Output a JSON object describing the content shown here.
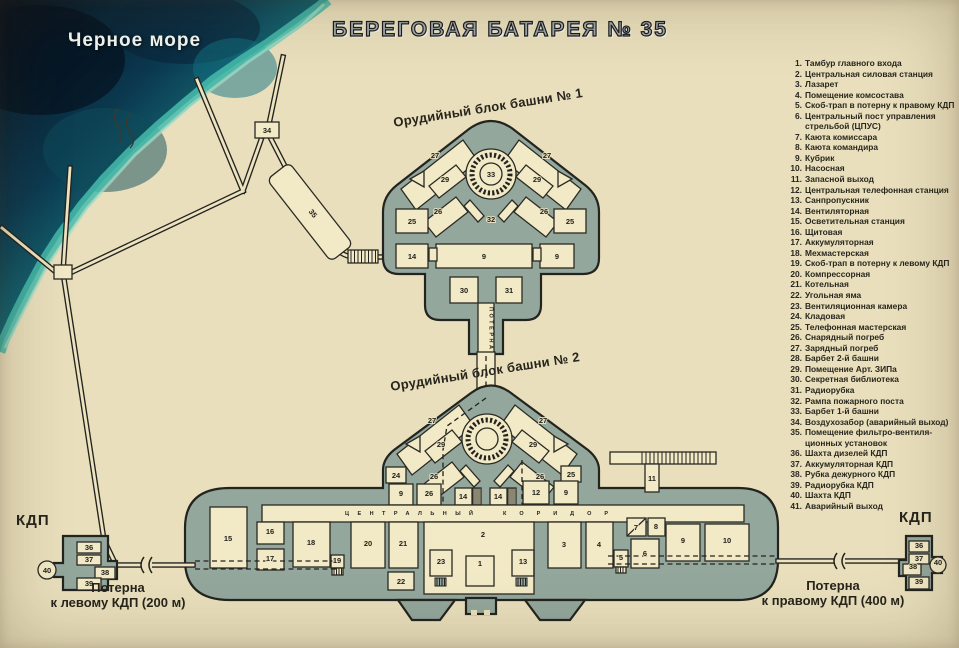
{
  "title": "БЕРЕГОВАЯ БАТАРЕЯ № 35",
  "sea": {
    "label": "Черное море"
  },
  "labels": {
    "turret1": "Орудийный блок башни № 1",
    "turret2": "Орудийный блок башни № 2",
    "kdp_left": "КДП",
    "kdp_right": "КДП",
    "potern_left_line1": "Потерна",
    "potern_left_line2": "к левому КДП (200 м)",
    "potern_right_line1": "Потерна",
    "potern_right_line2": "к правому КДП (400 м)",
    "corridor_word1": "ЦЕНТРАЛЬНЫЙ",
    "corridor_word2": "КОРИДОР",
    "potern_vertical": "ПОТЕРНА"
  },
  "colors": {
    "parchment": "#e9dfbc",
    "block_fill": "#93a79c",
    "room_fill": "#f2e9c6",
    "outline": "#24231e",
    "sea_deep": "#050f1c",
    "sea_shallow": "#35a99a"
  },
  "legend": {
    "items": [
      {
        "num": "1.",
        "text": "Тамбур главного входа"
      },
      {
        "num": "2.",
        "text": "Центральная силовая станция"
      },
      {
        "num": "3.",
        "text": "Лазарет"
      },
      {
        "num": "4.",
        "text": "Помещение комсостава"
      },
      {
        "num": "5.",
        "text": "Скоб-трап в потерну к правому КДП"
      },
      {
        "num": "6.",
        "text": "Центральный пост управления стрельбой (ЦПУС)"
      },
      {
        "num": "7.",
        "text": "Каюта комиссара"
      },
      {
        "num": "8.",
        "text": "Каюта командира"
      },
      {
        "num": "9.",
        "text": "Кубрик"
      },
      {
        "num": "10.",
        "text": "Насосная"
      },
      {
        "num": "11.",
        "text": "Запасной выход"
      },
      {
        "num": "12.",
        "text": "Центральная телефонная станция"
      },
      {
        "num": "13.",
        "text": "Санпропускник"
      },
      {
        "num": "14.",
        "text": "Вентиляторная"
      },
      {
        "num": "15.",
        "text": "Осветительная станция"
      },
      {
        "num": "16.",
        "text": "Щитовая"
      },
      {
        "num": "17.",
        "text": "Аккумуляторная"
      },
      {
        "num": "18.",
        "text": "Мехмастерская"
      },
      {
        "num": "19.",
        "text": "Скоб-трап в потерну к левому КДП"
      },
      {
        "num": "20.",
        "text": "Компрессорная"
      },
      {
        "num": "21.",
        "text": "Котельная"
      },
      {
        "num": "22.",
        "text": "Угольная яма"
      },
      {
        "num": "23.",
        "text": "Вентиляционная камера"
      },
      {
        "num": "24.",
        "text": "Кладовая"
      },
      {
        "num": "25.",
        "text": "Телефонная мастерская"
      },
      {
        "num": "26.",
        "text": "Снарядный погреб"
      },
      {
        "num": "27.",
        "text": "Зарядный погреб"
      },
      {
        "num": "28.",
        "text": "Барбет 2-й башни"
      },
      {
        "num": "29.",
        "text": "Помещение Арт. ЗИПа"
      },
      {
        "num": "30.",
        "text": "Секретная библиотека"
      },
      {
        "num": "31.",
        "text": "Радиорубка"
      },
      {
        "num": "32.",
        "text": "Рампа пожарного поста"
      },
      {
        "num": "33.",
        "text": "Барбет 1-й башни"
      },
      {
        "num": "34.",
        "text": "Воздухозабор (аварийный выход)"
      },
      {
        "num": "35.",
        "text": "Помещение фильтро-вентиля- ционных установок"
      },
      {
        "num": "36.",
        "text": "Шахта дизелей КДП"
      },
      {
        "num": "37.",
        "text": "Аккумуляторная КДП"
      },
      {
        "num": "38.",
        "text": "Рубка дежурного КДП"
      },
      {
        "num": "39.",
        "text": "Радиорубка КДП"
      },
      {
        "num": "40.",
        "text": "Шахта КДП"
      },
      {
        "num": "41.",
        "text": "Аварийный выход"
      }
    ]
  },
  "rooms": [
    {
      "n": "34",
      "x": 267,
      "y": 133
    },
    {
      "n": "35",
      "x": 311,
      "y": 215,
      "rot": 52
    },
    {
      "n": "27",
      "x": 435,
      "y": 158
    },
    {
      "n": "27",
      "x": 547,
      "y": 158
    },
    {
      "n": "29",
      "x": 445,
      "y": 182
    },
    {
      "n": "29",
      "x": 537,
      "y": 182
    },
    {
      "n": "33",
      "x": 491,
      "y": 177
    },
    {
      "n": "26",
      "x": 438,
      "y": 214
    },
    {
      "n": "26",
      "x": 544,
      "y": 214
    },
    {
      "n": "32",
      "x": 491,
      "y": 222
    },
    {
      "n": "25",
      "x": 412,
      "y": 224
    },
    {
      "n": "25",
      "x": 570,
      "y": 224
    },
    {
      "n": "14",
      "x": 412,
      "y": 259
    },
    {
      "n": "9",
      "x": 484,
      "y": 259
    },
    {
      "n": "9",
      "x": 557,
      "y": 259
    },
    {
      "n": "30",
      "x": 464,
      "y": 293
    },
    {
      "n": "31",
      "x": 509,
      "y": 293
    },
    {
      "n": "27",
      "x": 432,
      "y": 423
    },
    {
      "n": "27",
      "x": 543,
      "y": 423
    },
    {
      "n": "29",
      "x": 441,
      "y": 447
    },
    {
      "n": "29",
      "x": 533,
      "y": 447
    },
    {
      "n": "26",
      "x": 434,
      "y": 479
    },
    {
      "n": "26",
      "x": 540,
      "y": 479
    },
    {
      "n": "24",
      "x": 396,
      "y": 478
    },
    {
      "n": "25",
      "x": 571,
      "y": 477
    },
    {
      "n": "9",
      "x": 401,
      "y": 496
    },
    {
      "n": "26",
      "x": 429,
      "y": 496
    },
    {
      "n": "14",
      "x": 463,
      "y": 499
    },
    {
      "n": "14",
      "x": 498,
      "y": 499
    },
    {
      "n": "12",
      "x": 536,
      "y": 495
    },
    {
      "n": "9",
      "x": 566,
      "y": 495
    },
    {
      "n": "11",
      "x": 652,
      "y": 481
    },
    {
      "n": "15",
      "x": 228,
      "y": 541
    },
    {
      "n": "16",
      "x": 270,
      "y": 534
    },
    {
      "n": "17",
      "x": 270,
      "y": 561
    },
    {
      "n": "18",
      "x": 311,
      "y": 545
    },
    {
      "n": "19",
      "x": 337,
      "y": 563
    },
    {
      "n": "20",
      "x": 368,
      "y": 546
    },
    {
      "n": "21",
      "x": 403,
      "y": 546
    },
    {
      "n": "22",
      "x": 401,
      "y": 584
    },
    {
      "n": "23",
      "x": 441,
      "y": 564
    },
    {
      "n": "2",
      "x": 483,
      "y": 537
    },
    {
      "n": "1",
      "x": 480,
      "y": 566
    },
    {
      "n": "13",
      "x": 523,
      "y": 564
    },
    {
      "n": "3",
      "x": 564,
      "y": 547
    },
    {
      "n": "4",
      "x": 599,
      "y": 547
    },
    {
      "n": "5",
      "x": 621,
      "y": 560
    },
    {
      "n": "6",
      "x": 645,
      "y": 556
    },
    {
      "n": "7",
      "x": 636,
      "y": 530
    },
    {
      "n": "8",
      "x": 656,
      "y": 529
    },
    {
      "n": "9",
      "x": 683,
      "y": 543
    },
    {
      "n": "10",
      "x": 727,
      "y": 543
    },
    {
      "n": "36",
      "x": 89,
      "y": 550
    },
    {
      "n": "37",
      "x": 89,
      "y": 562
    },
    {
      "n": "38",
      "x": 105,
      "y": 575
    },
    {
      "n": "39",
      "x": 89,
      "y": 586
    },
    {
      "n": "40",
      "x": 47,
      "y": 573
    },
    {
      "n": "36",
      "x": 919,
      "y": 548
    },
    {
      "n": "37",
      "x": 919,
      "y": 561
    },
    {
      "n": "38",
      "x": 913,
      "y": 569
    },
    {
      "n": "39",
      "x": 919,
      "y": 584
    },
    {
      "n": "40",
      "x": 938,
      "y": 565
    }
  ]
}
